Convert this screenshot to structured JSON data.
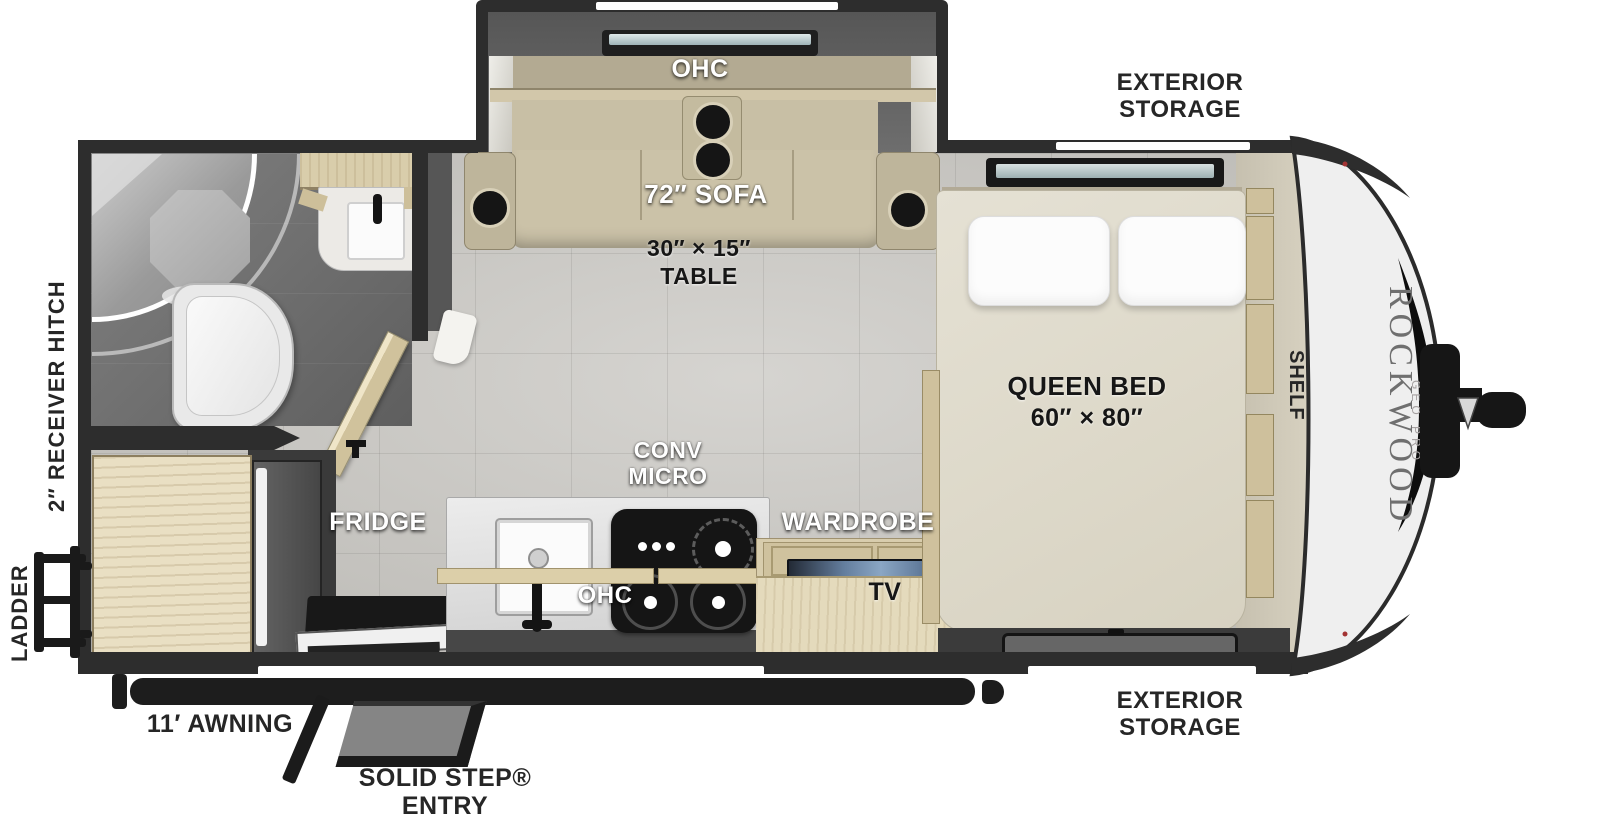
{
  "plan": {
    "brand": {
      "name": "ROCKWOOD",
      "series": "GEO PRO"
    },
    "colors": {
      "wall": "#2d2d2d",
      "floor_tile": "#c8c6c1",
      "wood": "#e0d4b2",
      "sofa_khaki": "#c8bfa5",
      "cap_silver": "#efefef",
      "label_dark": "#262626"
    },
    "living": {
      "ohc": "OHC",
      "sofa": "72″ SOFA",
      "table_line1": "30″ × 15″",
      "table_line2": "TABLE"
    },
    "kitchen": {
      "conv_line1": "CONV",
      "conv_line2": "MICRO",
      "fridge": "FRIDGE",
      "ohc": "OHC"
    },
    "bedroom": {
      "wardrobe": "WARDROBE",
      "tv": "TV",
      "bed_line1": "QUEEN BED",
      "bed_line2": "60″ × 80″",
      "shelf": "SHELF"
    },
    "exterior": {
      "storage_top_line1": "EXTERIOR",
      "storage_top_line2": "STORAGE",
      "storage_bottom_line1": "EXTERIOR",
      "storage_bottom_line2": "STORAGE",
      "receiver_hitch": "2″ RECEIVER HITCH",
      "ladder": "LADDER",
      "awning": "11′ AWNING",
      "entry_line1": "SOLID STEP®",
      "entry_line2": "ENTRY"
    }
  }
}
